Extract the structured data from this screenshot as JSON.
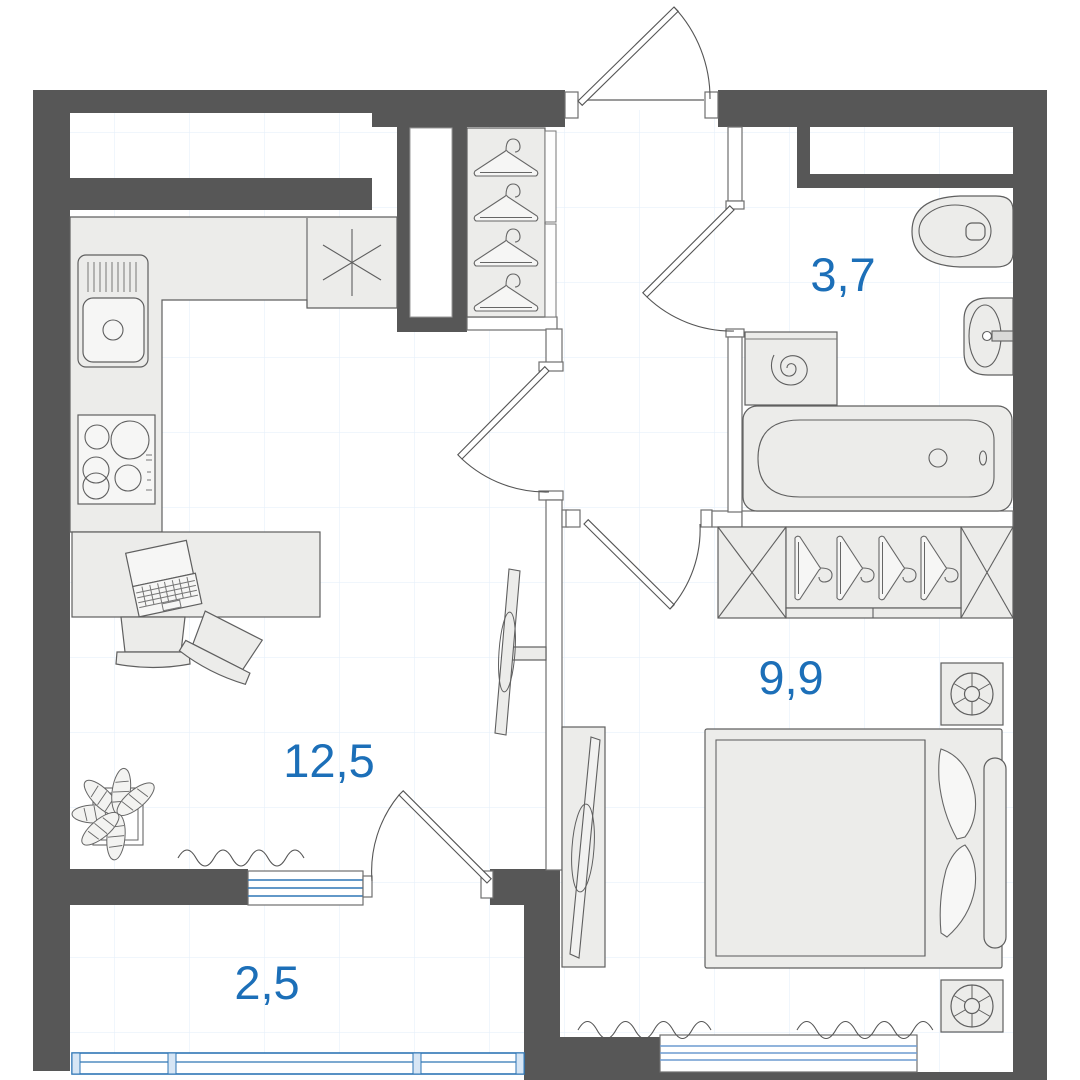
{
  "plan": {
    "type": "apartment-floor-plan",
    "labels": {
      "bathroom_area": "3,7",
      "bedroom_area": "9,9",
      "living_area": "12,5",
      "balcony_area": "2,5"
    },
    "colors": {
      "wall": "#575757",
      "accent_blue": "#1c6fb8",
      "window_blue": "#2f76b5",
      "window_blue_light": "#6d9bd1",
      "furniture_fill": "#ececea",
      "grid_line": "#e7f0fa"
    }
  }
}
